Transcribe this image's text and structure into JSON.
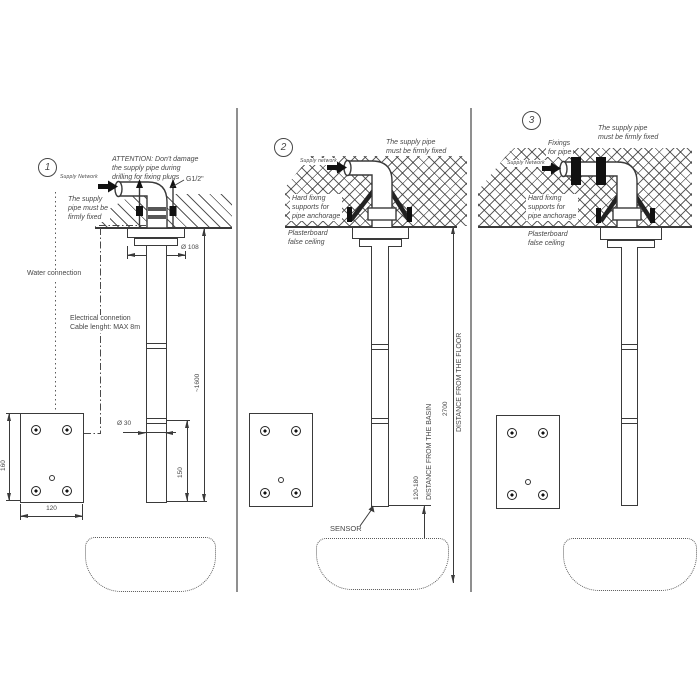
{
  "panel1": {
    "number": "1",
    "attention_l1": "ATTENTION: Don't damage",
    "attention_l2": "the supply pipe during",
    "attention_l3": "drilling for fixing plugs",
    "supply_network": "Supply Network",
    "thread_size": "G1/2\"",
    "firmly_l1": "The supply",
    "firmly_l2": "pipe must be",
    "firmly_l3": "firmly fixed",
    "water_connection": "Water connection",
    "electrical_l1": "Electrical connetion",
    "electrical_l2": "Cable lenght: MAX 8m",
    "dim_flange": "Ø 108",
    "dim_pipe": "Ø 30",
    "dim_height": "~1600",
    "dim_sensor": "150",
    "dim_plate_h": "160",
    "dim_plate_w": "120"
  },
  "panel2": {
    "number": "2",
    "firmly_l1": "The supply pipe",
    "firmly_l2": "must be firmly fixed",
    "supply_network": "Supply network",
    "hard_fixing_l1": "Hard fixing",
    "hard_fixing_l2": "supports for",
    "hard_fixing_l3": "pipe anchorage",
    "plasterboard_l1": "Plasterboard",
    "plasterboard_l2": "false ceiling",
    "sensor": "SENSOR",
    "dim_basin_range": "120-180",
    "dim_basin_label": "DISTANCE FROM THE BASIN",
    "dim_floor": "2700",
    "dim_floor_label": "DISTANCE FROM THE FLOOR"
  },
  "panel3": {
    "number": "3",
    "fixings_l1": "Fixings",
    "fixings_l2": "for pipe",
    "firmly_l1": "The supply pipe",
    "firmly_l2": "must be firmly fixed",
    "supply_network": "Supply Network",
    "hard_fixing_l1": "Hard fixing",
    "hard_fixing_l2": "supports for",
    "hard_fixing_l3": "pipe anchorage",
    "plasterboard_l1": "Plasterboard",
    "plasterboard_l2": "false ceiling"
  },
  "colors": {
    "line": "#3a3a3a",
    "text": "#474747",
    "divider": "#8f8f8f"
  }
}
